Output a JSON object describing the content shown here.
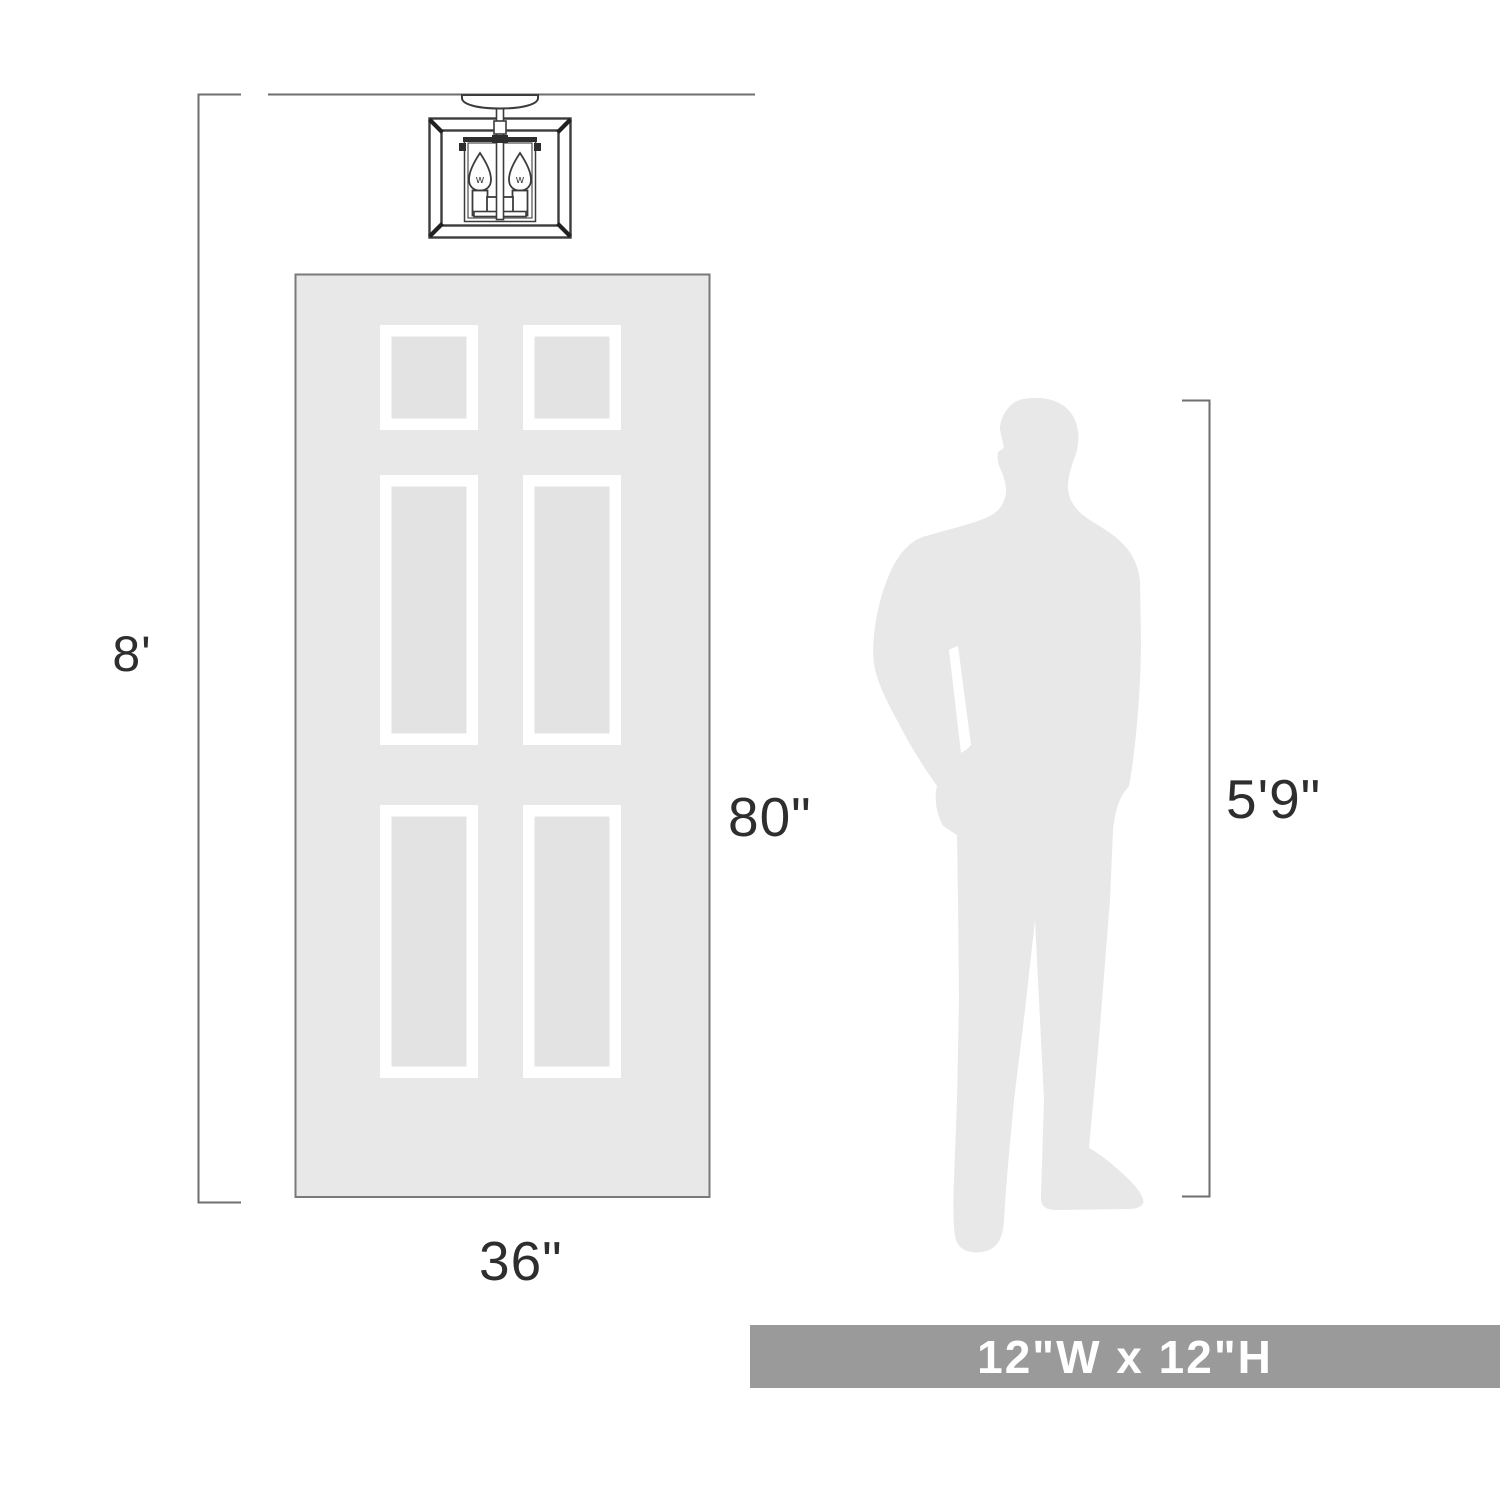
{
  "labels": {
    "ceiling_height": "8'",
    "door_height": "80\"",
    "door_width": "36\"",
    "person_height": "5'9\""
  },
  "fixture": {
    "bulb_label": "w"
  },
  "banner": {
    "text": "12\"W x 12\"H"
  },
  "colors": {
    "dimension_line": "#6e6e6e",
    "drawing_line": "#3c3c3c",
    "door_fill": "#e8e8e8",
    "door_border": "#7a7a7a",
    "panel_frame": "#ffffff",
    "panel_fill": "#e3e3e3",
    "silhouette_fill": "#e8e8e8",
    "banner_background": "#9a9a9a",
    "banner_text": "#ffffff",
    "label_text": "#2e2e2e"
  }
}
